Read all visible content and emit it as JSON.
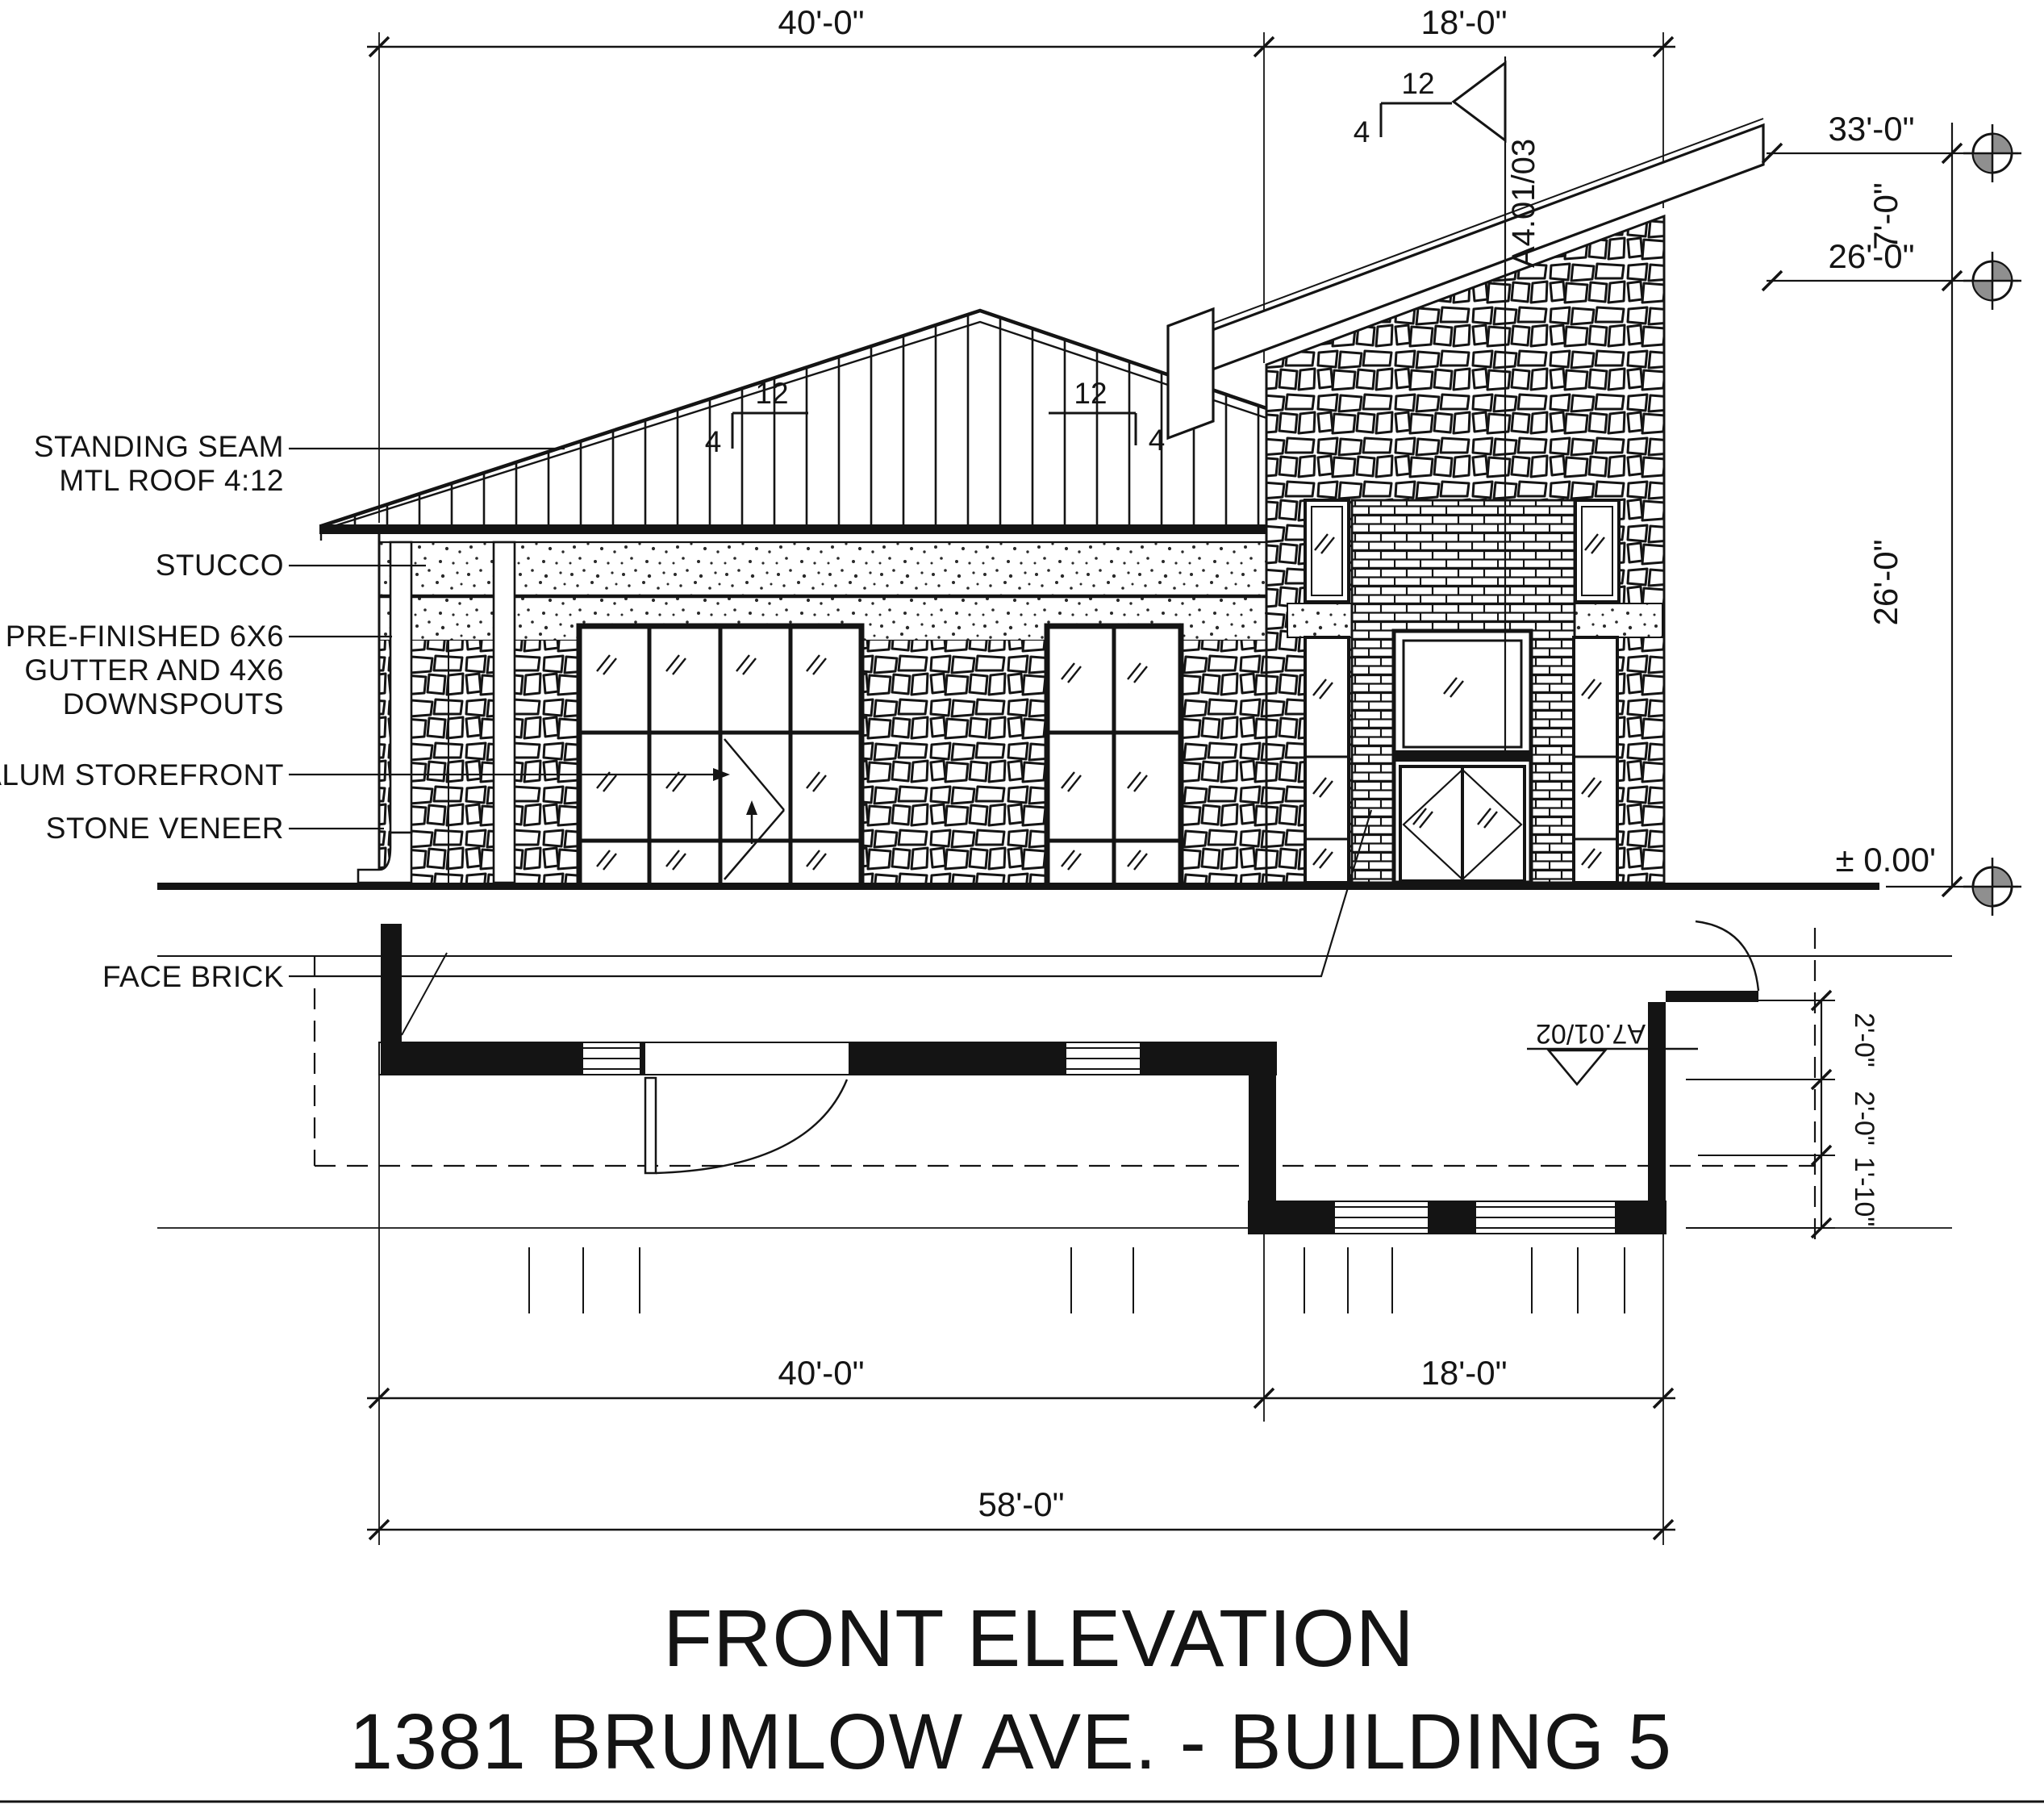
{
  "title": {
    "main": "FRONT ELEVATION",
    "subtitle": "1381 BRUMLOW AVE. - BUILDING 5"
  },
  "materials": {
    "roof_line1": "STANDING SEAM",
    "roof_line2": "MTL ROOF 4:12",
    "stucco": "STUCCO",
    "gutter_line1": "PRE-FINISHED 6X6",
    "gutter_line2": "GUTTER AND 4X6",
    "gutter_line3": "DOWNSPOUTS",
    "storefront": "ALUM STOREFRONT",
    "stone": "STONE VENEER",
    "brick": "FACE BRICK"
  },
  "dims": {
    "top_main": "40'-0\"",
    "top_tower": "18'-0\"",
    "bottom_main": "40'-0\"",
    "bottom_tower": "18'-0\"",
    "bottom_total": "58'-0\"",
    "level_parapet": "33'-0\"",
    "level_offset": "7'-0\"",
    "level_fascia": "26'-0\"",
    "tower_height": "26'-0\"",
    "level_ground": "± 0.00'",
    "plan_1": "2'-0\"",
    "plan_2": "2'-0\"",
    "plan_3": "1'-10\""
  },
  "slopes": {
    "rise": "4",
    "run": "12"
  },
  "callouts": {
    "section": "A4.01/03",
    "plan_detail": "A7.01/02"
  }
}
